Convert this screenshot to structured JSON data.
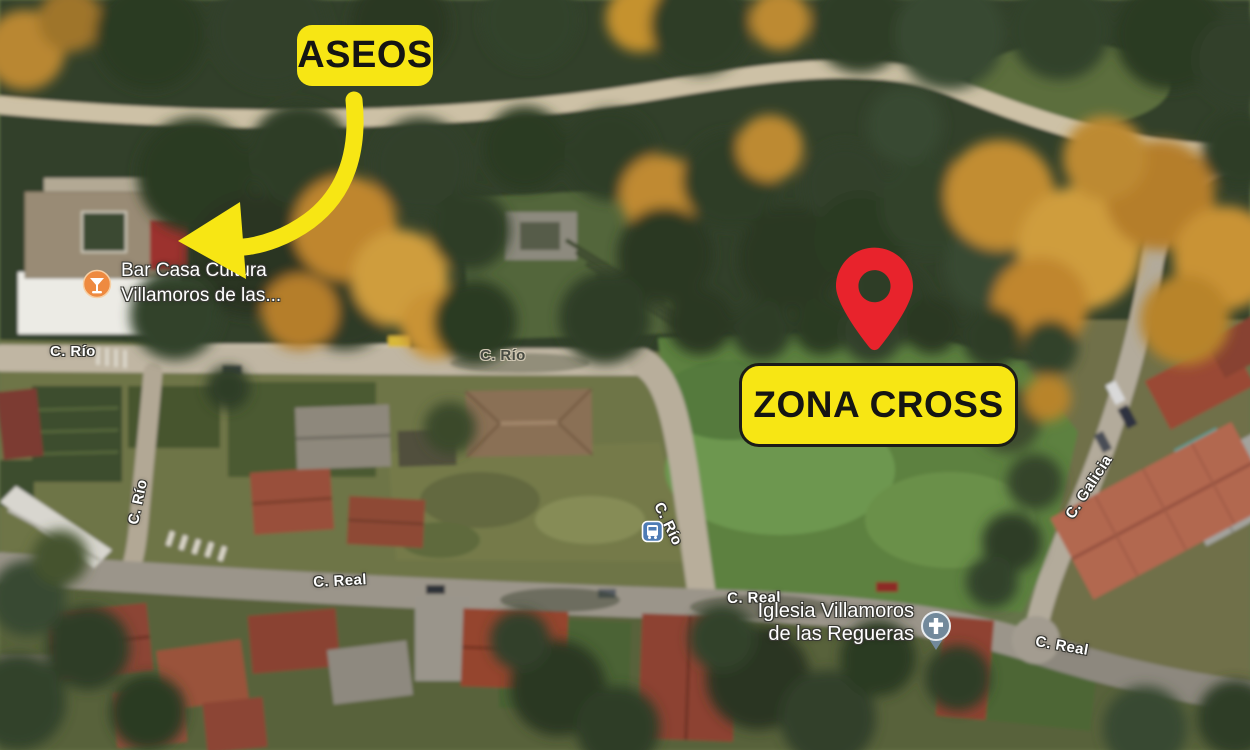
{
  "annotations": {
    "aseos_label": "ASEOS",
    "zona_cross_label": "ZONA CROSS",
    "highlight_color": "#f7e614",
    "pin_color": "#e8232c"
  },
  "roads": {
    "rio": "C. Río",
    "real": "C. Real",
    "galicia": "C. Galicia"
  },
  "pois": {
    "bar": {
      "line1": "Bar Casa Cultura",
      "line2": "Villamoros de las...",
      "icon_color": "#ee8a40"
    },
    "church": {
      "line1": "Iglesia Villamoros",
      "line2": "de las Regueras",
      "icon_color": "#72899b"
    },
    "bus_icon_color": "#4e7cb5"
  }
}
